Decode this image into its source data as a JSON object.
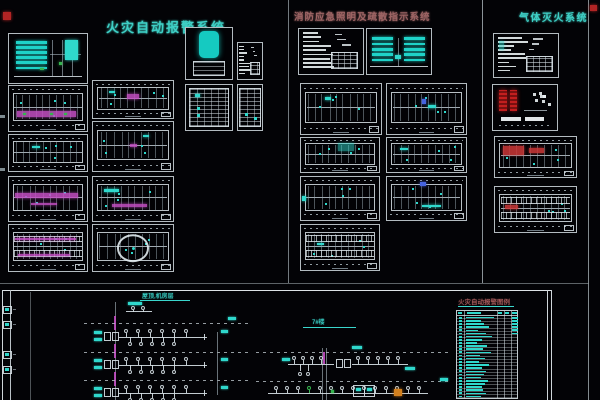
{
  "titles": {
    "left": "火灾自动报警系统",
    "middle": "消防应急照明及疏散指示系统",
    "right": "气体灭火系统"
  },
  "riser": {
    "roof_label": "屋顶,机房层",
    "building_label": "7#楼"
  },
  "legend": {
    "title": "火灾自动报警图例",
    "rows": [
      {
        "w": 0.95,
        "r": true
      },
      {
        "w": 0.5,
        "r": true
      },
      {
        "w": 0.62,
        "r": true
      },
      {
        "w": 0.8,
        "r": true
      },
      {
        "w": 0.42,
        "r": true
      },
      {
        "w": 0.68,
        "r": true
      },
      {
        "w": 0.9,
        "r": false
      },
      {
        "w": 0.54,
        "r": false
      },
      {
        "w": 0.38,
        "r": false
      },
      {
        "w": 0.74,
        "r": false
      },
      {
        "w": 0.6,
        "r": false
      },
      {
        "w": 0.86,
        "r": false
      },
      {
        "w": 0.48,
        "r": false
      },
      {
        "w": 0.66,
        "r": false
      },
      {
        "w": 0.44,
        "r": false
      },
      {
        "w": 0.78,
        "r": false
      },
      {
        "w": 0.56,
        "r": false
      },
      {
        "w": 0.7,
        "r": false
      },
      {
        "w": 0.62,
        "r": false
      },
      {
        "w": 0.5,
        "r": false
      },
      {
        "w": 0.76,
        "r": false
      },
      {
        "w": 0.64,
        "r": false
      },
      {
        "w": 0.55,
        "r": false
      },
      {
        "w": 0.6,
        "r": false
      },
      {
        "w": 0.7,
        "r": false
      },
      {
        "w": 0.52,
        "r": false
      }
    ]
  },
  "colors": {
    "background": "#030306",
    "line_white": "#d9e0e4",
    "cyan": "#2fd8cc",
    "magenta": "#c44fc4",
    "red": "#c23535",
    "green": "#35b44e",
    "blue": "#4664e0",
    "orange": "#d2801e",
    "title_teal": "#3ecfc5",
    "title_rose": "#9d6464"
  },
  "panels": [
    {
      "id": "fa-elevation",
      "x": 8,
      "y": 33,
      "w": 80,
      "h": 51,
      "motif": "elevation",
      "accents": [
        {
          "x": 72,
          "y": 12,
          "w": 16,
          "h": 42,
          "c": "cyan"
        },
        {
          "x": 64,
          "y": 58,
          "w": 4,
          "h": 5,
          "c": "green"
        },
        {
          "x": 40,
          "y": 70,
          "w": 5,
          "h": 4,
          "c": "green"
        }
      ]
    },
    {
      "id": "fa-plan-1",
      "x": 8,
      "y": 85,
      "w": 80,
      "h": 47,
      "motif": "plan",
      "accents": [
        {
          "x": 10,
          "y": 56,
          "w": 76,
          "h": 13,
          "c": "magenta"
        },
        {
          "x": 18,
          "y": 60,
          "w": 4,
          "h": 5,
          "c": "green"
        },
        {
          "x": 52,
          "y": 60,
          "w": 4,
          "h": 5,
          "c": "green"
        },
        {
          "x": 70,
          "y": 60,
          "w": 4,
          "h": 5,
          "c": "green"
        }
      ]
    },
    {
      "id": "fa-plan-2",
      "x": 8,
      "y": 134,
      "w": 80,
      "h": 38,
      "motif": "plan",
      "accents": [
        {
          "x": 30,
          "y": 30,
          "w": 10,
          "h": 5,
          "c": "cyan"
        }
      ]
    },
    {
      "id": "fa-plan-3",
      "x": 8,
      "y": 176,
      "w": 80,
      "h": 46,
      "motif": "plan",
      "accents": [
        {
          "x": 8,
          "y": 36,
          "w": 80,
          "h": 12,
          "c": "magenta"
        },
        {
          "x": 28,
          "y": 58,
          "w": 34,
          "h": 6,
          "c": "magenta"
        }
      ]
    },
    {
      "id": "fa-plan-4",
      "x": 8,
      "y": 224,
      "w": 80,
      "h": 48,
      "motif": "plan-dense",
      "accents": [
        {
          "x": 8,
          "y": 28,
          "w": 78,
          "h": 4,
          "c": "magenta"
        },
        {
          "x": 12,
          "y": 64,
          "w": 66,
          "h": 4,
          "c": "magenta"
        }
      ]
    },
    {
      "id": "fa-plan-5",
      "x": 92,
      "y": 80,
      "w": 82,
      "h": 39,
      "motif": "plan",
      "accents": [
        {
          "x": 42,
          "y": 34,
          "w": 16,
          "h": 16,
          "c": "magenta"
        },
        {
          "x": 20,
          "y": 28,
          "w": 8,
          "h": 5,
          "c": "cyan"
        }
      ]
    },
    {
      "id": "fa-plan-6",
      "x": 92,
      "y": 121,
      "w": 82,
      "h": 51,
      "motif": "plan",
      "accents": [
        {
          "x": 46,
          "y": 44,
          "w": 9,
          "h": 7,
          "c": "magenta"
        },
        {
          "x": 62,
          "y": 26,
          "w": 8,
          "h": 5,
          "c": "cyan"
        }
      ]
    },
    {
      "id": "fa-plan-7",
      "x": 92,
      "y": 176,
      "w": 82,
      "h": 46,
      "motif": "plan",
      "accents": [
        {
          "x": 24,
          "y": 62,
          "w": 44,
          "h": 6,
          "c": "magenta"
        },
        {
          "x": 14,
          "y": 28,
          "w": 18,
          "h": 5,
          "c": "cyan"
        }
      ]
    },
    {
      "id": "fa-plan-circle",
      "x": 92,
      "y": 224,
      "w": 82,
      "h": 48,
      "motif": "circle-plan",
      "accents": []
    },
    {
      "id": "fa-tank",
      "x": 185,
      "y": 27,
      "w": 48,
      "h": 53,
      "motif": "tank",
      "accents": []
    },
    {
      "id": "fa-grid-1",
      "x": 185,
      "y": 84,
      "w": 48,
      "h": 47,
      "motif": "grid",
      "accents": [
        {
          "x": 20,
          "y": 20,
          "w": 10,
          "h": 6,
          "c": "cyan"
        }
      ]
    },
    {
      "id": "fa-small-1",
      "x": 237,
      "y": 42,
      "w": 26,
      "h": 38,
      "motif": "notes",
      "accents": []
    },
    {
      "id": "fa-small-2",
      "x": 237,
      "y": 84,
      "w": 26,
      "h": 47,
      "motif": "grid",
      "accents": []
    },
    {
      "id": "el-notes",
      "x": 298,
      "y": 28,
      "w": 66,
      "h": 47,
      "motif": "notes",
      "accents": []
    },
    {
      "id": "el-elevation",
      "x": 366,
      "y": 28,
      "w": 66,
      "h": 47,
      "motif": "elevation2",
      "accents": [
        {
          "x": 44,
          "y": 58,
          "w": 9,
          "h": 8,
          "c": "cyan"
        }
      ]
    },
    {
      "id": "el-plan-1",
      "x": 300,
      "y": 83,
      "w": 82,
      "h": 52,
      "motif": "plan",
      "accents": [
        {
          "x": 30,
          "y": 26,
          "w": 8,
          "h": 5,
          "c": "cyan"
        }
      ]
    },
    {
      "id": "el-plan-2",
      "x": 386,
      "y": 83,
      "w": 81,
      "h": 52,
      "motif": "plan",
      "accents": [
        {
          "x": 44,
          "y": 30,
          "w": 6,
          "h": 9,
          "c": "blue"
        },
        {
          "x": 52,
          "y": 42,
          "w": 10,
          "h": 5,
          "c": "cyan"
        }
      ]
    },
    {
      "id": "el-plan-3",
      "x": 300,
      "y": 137,
      "w": 80,
      "h": 36,
      "motif": "plan",
      "accents": [
        {
          "x": 48,
          "y": 16,
          "w": 20,
          "h": 22,
          "c": "cyan-soft"
        }
      ]
    },
    {
      "id": "el-plan-4",
      "x": 386,
      "y": 137,
      "w": 81,
      "h": 36,
      "motif": "plan",
      "accents": [
        {
          "x": 16,
          "y": 30,
          "w": 10,
          "h": 5,
          "c": "cyan"
        }
      ]
    },
    {
      "id": "el-plan-5",
      "x": 300,
      "y": 176,
      "w": 80,
      "h": 45,
      "motif": "plan",
      "accents": [
        {
          "x": 1,
          "y": 44,
          "w": 6,
          "h": 13,
          "c": "cyan"
        }
      ]
    },
    {
      "id": "el-plan-6",
      "x": 386,
      "y": 176,
      "w": 81,
      "h": 45,
      "motif": "plan",
      "accents": [
        {
          "x": 44,
          "y": 64,
          "w": 24,
          "h": 6,
          "c": "cyan"
        },
        {
          "x": 42,
          "y": 12,
          "w": 8,
          "h": 9,
          "c": "blue"
        }
      ]
    },
    {
      "id": "el-plan-7",
      "x": 300,
      "y": 224,
      "w": 80,
      "h": 47,
      "motif": "plan-dense",
      "accents": [
        {
          "x": 20,
          "y": 40,
          "w": 10,
          "h": 5,
          "c": "cyan"
        }
      ]
    },
    {
      "id": "gas-notes",
      "x": 493,
      "y": 33,
      "w": 66,
      "h": 45,
      "motif": "notes",
      "accents": [
        {
          "x": 8,
          "y": 16,
          "w": 8,
          "h": 22,
          "c": "cyan-soft"
        }
      ]
    },
    {
      "id": "gas-detail",
      "x": 492,
      "y": 84,
      "w": 66,
      "h": 47,
      "motif": "gas",
      "accents": []
    },
    {
      "id": "gas-plan-1",
      "x": 494,
      "y": 136,
      "w": 83,
      "h": 42,
      "motif": "plan",
      "accents": [
        {
          "x": 10,
          "y": 22,
          "w": 26,
          "h": 24,
          "c": "red-soft"
        },
        {
          "x": 42,
          "y": 28,
          "w": 18,
          "h": 11,
          "c": "red-soft"
        }
      ]
    },
    {
      "id": "gas-plan-2",
      "x": 494,
      "y": 186,
      "w": 83,
      "h": 47,
      "motif": "plan-dense",
      "accents": [
        {
          "x": 12,
          "y": 40,
          "w": 16,
          "h": 9,
          "c": "red-soft"
        }
      ]
    }
  ]
}
